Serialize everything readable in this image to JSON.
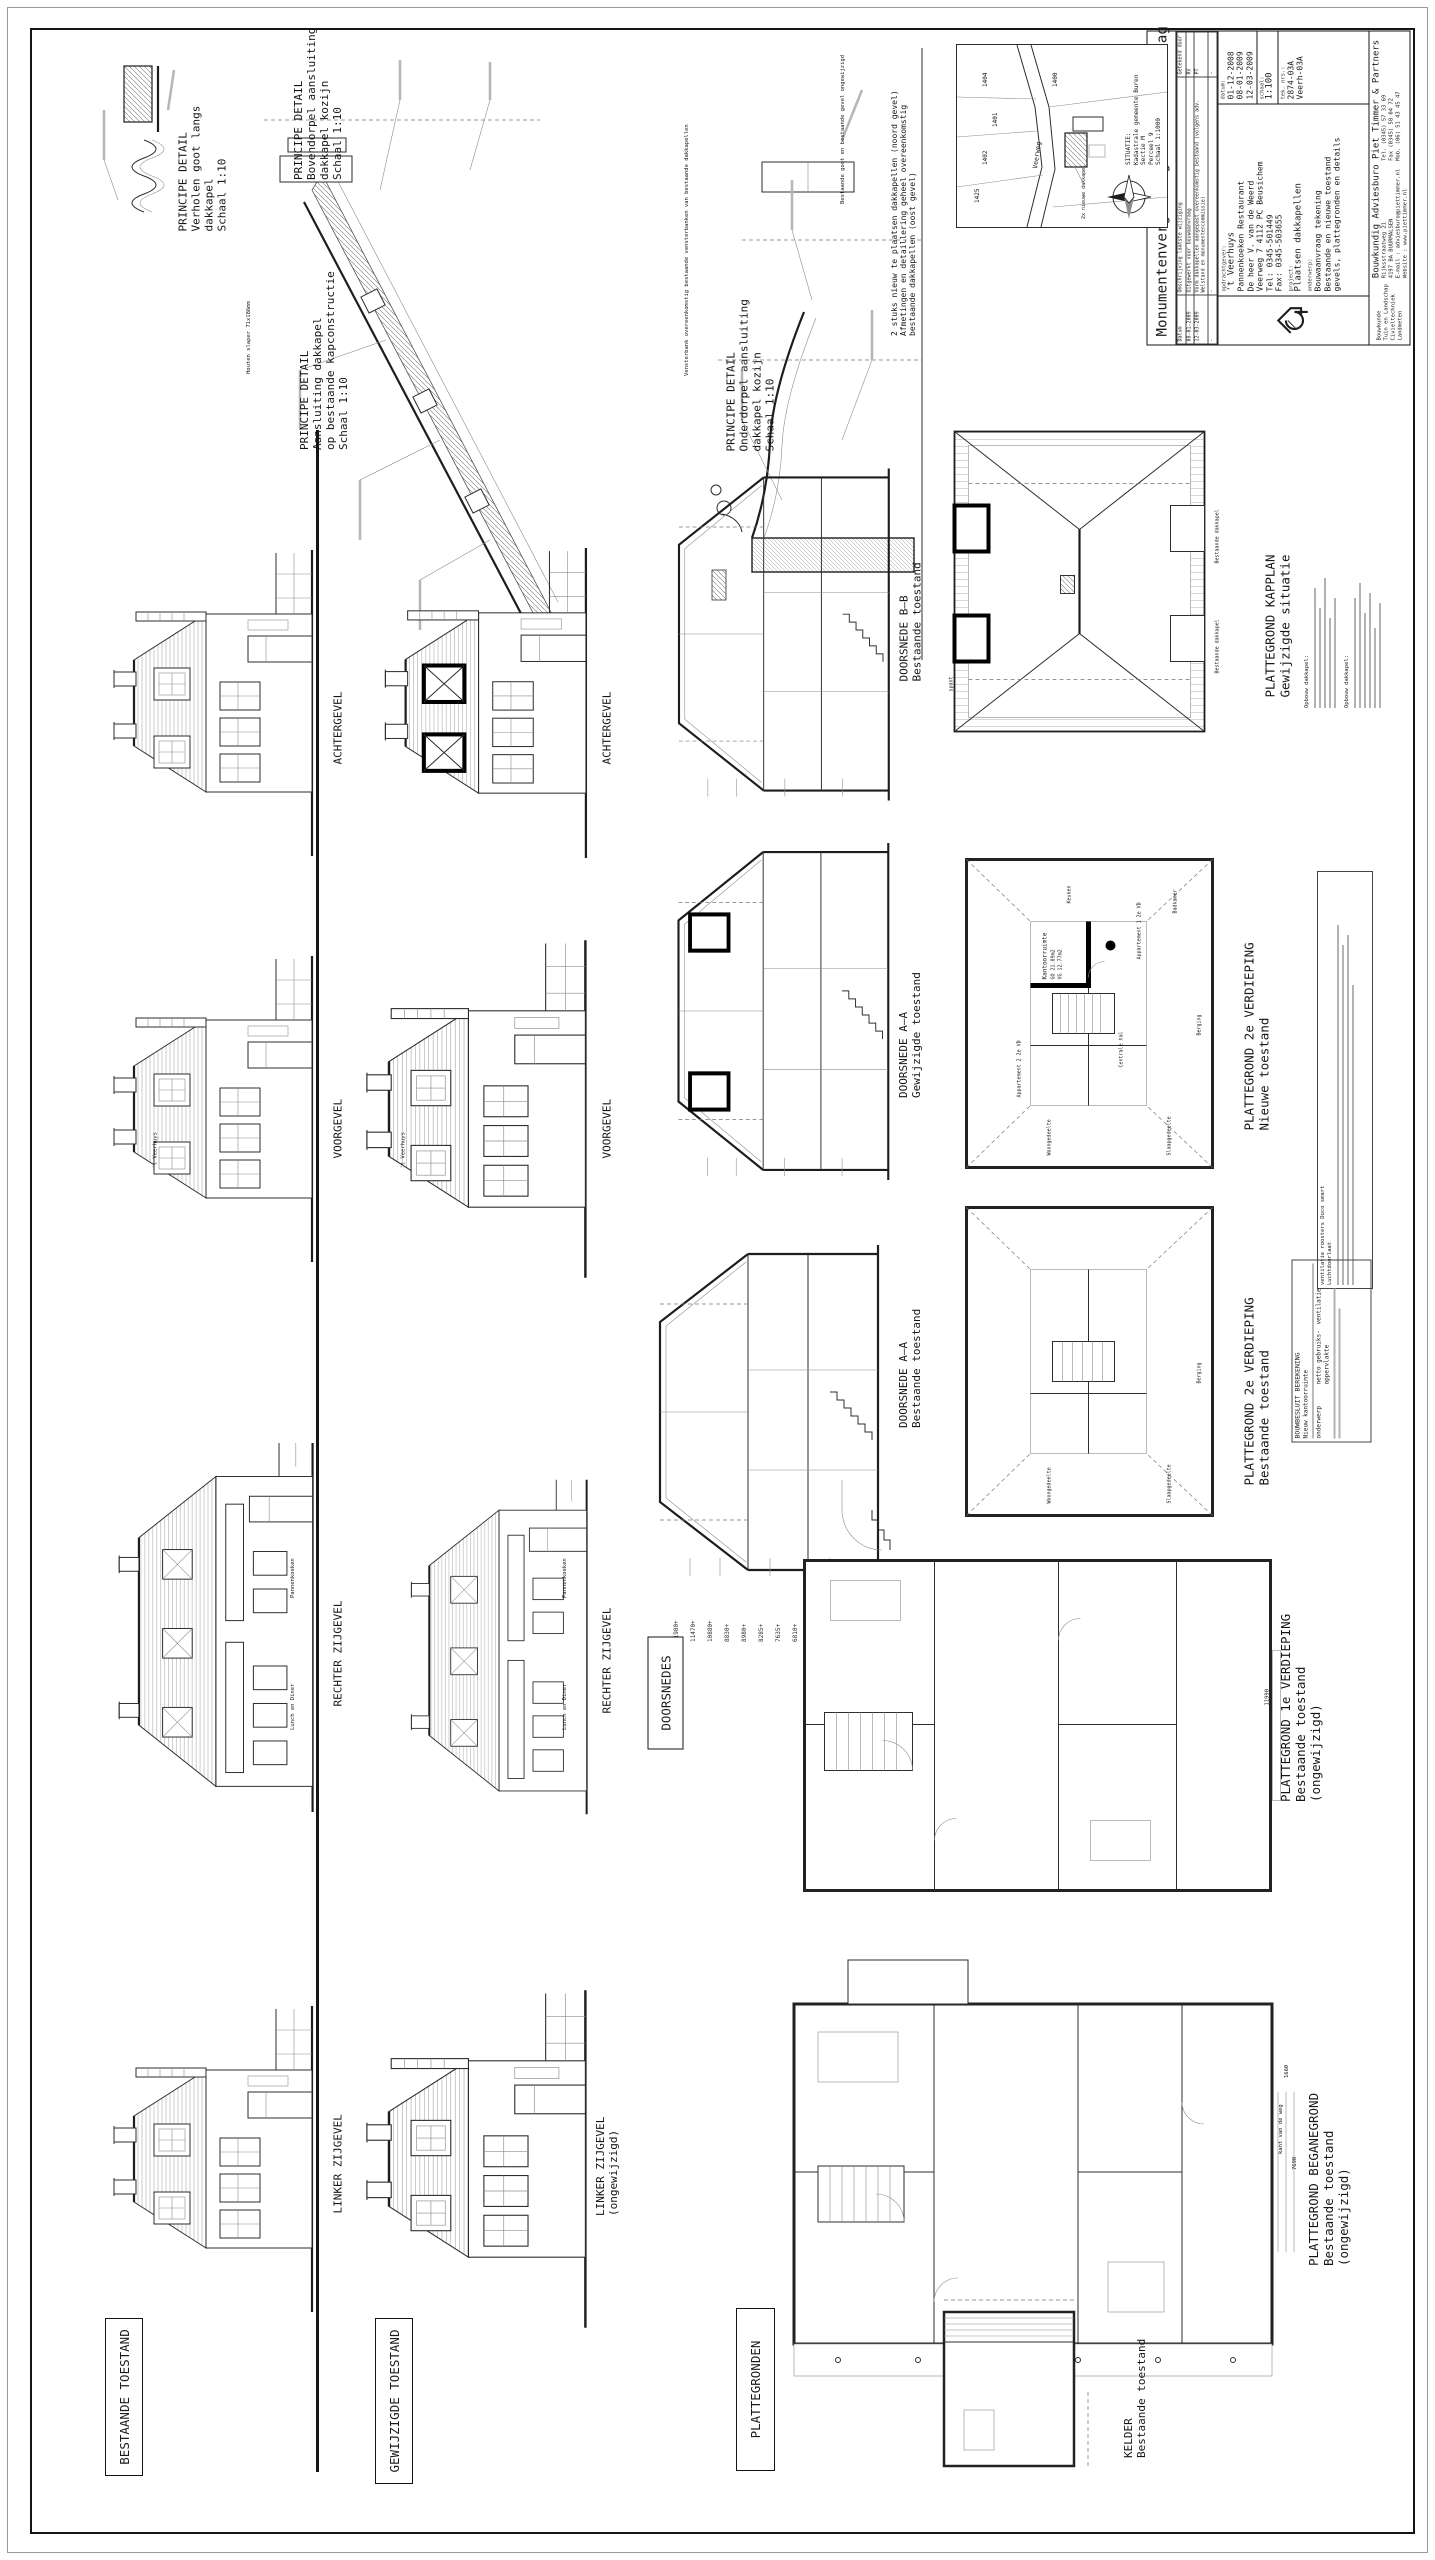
{
  "title_block": {
    "title": "Monumentenvergunning en Bouwaanvraag",
    "rev_headers": [
      "Datum",
      "Omschrijving laatste wijziging",
      "Getekend door"
    ],
    "rev_rows": [
      [
        "08-01-2009",
        "Uitgewerkt voor bouwaanvraag",
        "RV"
      ],
      [
        "12-03-2009",
        "Vorm dakkapellen aangepast overeenkomstig bestaand (volgens adv. Welstand en monumentencommissie)",
        "PT"
      ],
      [
        "-",
        "-",
        "-"
      ]
    ],
    "opdrachtgever_label": "opdrachtgever:",
    "opdrachtgever": [
      "'t Veerhuys",
      "Pannenkoeken  Restaurant",
      "De heer V. van de Weerd",
      "Veerweg 7  4112 PC  Beusichem",
      "Tel:  0345-501449",
      "Fax:  0345-503655"
    ],
    "project_label": "project:",
    "project": "Plaatsen dakkapellen",
    "onderwerp_label": "onderwerp:",
    "onderwerp": [
      "Bouwaanvraag tekening",
      "Bestaande en nieuwe toestand",
      "gevels, plattegronden en details"
    ],
    "datum_label": "datum:",
    "datums": [
      "01-12-2008",
      "08-01-2009",
      "12-03-2009"
    ],
    "schaal_label": "schaal:",
    "schaal": "1:100",
    "teknr_label": "tek. nrs.:",
    "teknrs": [
      "2874-03A",
      "Veerh-03A"
    ],
    "bureau": "Bouwkundig Adviesburo Piet Timmer & Partners",
    "diensten": [
      "Bouwkunde",
      "Tuin en Landschap",
      "Civieltechniek",
      "Landmeten"
    ],
    "adres": [
      "Rijksstraatweg 21",
      "4197 BA  BUURMALSEN",
      "E-mail : adviesburo@piettimmer.nl",
      "Website : www.piettimmer.nl"
    ],
    "contact": [
      "Tel.  (0345) 57 33 69",
      "Fax  (0345) 58 04 72",
      "Mob. (06) 51 43 45 47"
    ]
  },
  "situatie": {
    "caption": [
      "SITUATIE:",
      "Kadastrale gemeente Buren",
      "Sectie M",
      "Perceel 9",
      "Schaal 1:1000"
    ],
    "street": "Veerweg",
    "parcels": [
      "1400",
      "1401",
      "1402",
      "1404",
      "1425"
    ],
    "annotation": "2x nieuwe dakkapel"
  },
  "note_dakkapellen": [
    "2 stuks nieuw te plaatsen dakkapellen (noord gevel)",
    "Afmetingen en detaillering geheel overeenkomstig",
    "bestaande dakkapellen (oost gevel)"
  ],
  "details": {
    "d1": [
      "PRINCIPE DETAIL",
      "Verholen goot langs",
      "dakkapel",
      "Schaal 1:10"
    ],
    "d2": [
      "PRINCIPE DETAIL",
      "Bovendorpel aansluiting",
      "dakkapel kozijn",
      "Schaal 1:10"
    ],
    "d3": [
      "PRINCIPE DETAIL",
      "Aansluiting dakkapel",
      "op bestaande kapconstructie",
      "Schaal 1:10"
    ],
    "d4": [
      "PRINCIPE DETAIL",
      "Onderdorpel aansluiting",
      "dakkapel kozijn",
      "Schaal 1:10"
    ],
    "ann_goot": "Bestaande goot en bestaande gevel ongewijzigd",
    "ann_slaper": "Houten slaper 71x186mm",
    "ann_vensterbank": "Vensterbank overeenkomstig bestaande vensterbanken van bestaande dakkapellen"
  },
  "sections": {
    "bb": [
      "DOORSNEDE B–B",
      "Bestaande toestand"
    ],
    "aa_gew": [
      "DOORSNEDE A–A",
      "Gewijzigde toestand"
    ],
    "aa_best": [
      "DOORSNEDE A–A",
      "Bestaande toestand"
    ],
    "levels": [
      "11980+",
      "11470+",
      "10880+",
      "8830+",
      "8980+",
      "8285+",
      "7635+",
      "6810+",
      "3470+"
    ],
    "group_label": "DOORSNEDES"
  },
  "plans": {
    "kapplan": [
      "PLATTEGROND KAPPLAN",
      "Gewijzigde situatie"
    ],
    "kapplan_note_heading": "Opbouw dakkapel:",
    "kapplan_dormer_label": "Bestaande dakkapel",
    "v2n": [
      "PLATTEGROND 2e VERDIEPING",
      "Nieuwe toestand"
    ],
    "v2b": [
      "PLATTEGROND 2e VERDIEPING",
      "Bestaande toestand"
    ],
    "v1": [
      "PLATTEGROND 1e VERDIEPING",
      "Bestaande toestand",
      "(ongewijzigd)"
    ],
    "bg": [
      "PLATTEGROND BEGANEGROND",
      "Bestaande toestand",
      "(ongewijzigd)"
    ],
    "kelder": [
      "KELDER",
      "Bestaande toestand"
    ],
    "group_label": "PLATTEGRONDEN",
    "dims": {
      "v1_breedte": "11990",
      "bg_diepte": "7690",
      "bg_stoep": "1660",
      "bg_weg": "kant van de weg",
      "spant": "spant"
    },
    "rooms_v2n": {
      "kantoor": "Kantoorruimte",
      "kantoor_go": "GO 21.89m2",
      "kantoor_vg": "VG 12.77m2",
      "app1": "Appartement 1 2e VD",
      "app2": "Appartement 2 2e VD",
      "hal": "Centrale hal",
      "woon": "Woongedeelte",
      "slaap": "Slaapgedeelte",
      "keuken": "Keuken",
      "bad": "Badkamer",
      "berging": "Berging"
    },
    "bouwbesluit": [
      "BOUWBESLUIT BEREKENING",
      "Nieuw kantoorruimte"
    ],
    "bouwbesluit_cols": [
      "onderwerp",
      "netto gebruiks- oppervlakte",
      "ventilatie"
    ],
    "vent_note": [
      "ventilatie roosters Duco smart",
      "Luchtdoorlaat"
    ]
  },
  "elevations": {
    "achtergevel": "ACHTERGEVEL",
    "voorgevel": "VOORGEVEL",
    "rechter": "RECHTER ZIJGEVEL",
    "linker": "LINKER ZIJGEVEL",
    "ongewijzigd": "(ongewijzigd)",
    "group_bestaand": "BESTAANDE TOESTAND",
    "group_gewijzigd": "GEWIJZIGDE TOESTAND",
    "sign_veerhuys": "'t Veerhuys",
    "sign_pannenkoeken": "Pannenkoeken",
    "sign_lunch": "Lunch en Diner"
  },
  "colors": {
    "ink": "#1a1a1a",
    "thin": "#8d8d8d",
    "new_work": "#000000"
  }
}
